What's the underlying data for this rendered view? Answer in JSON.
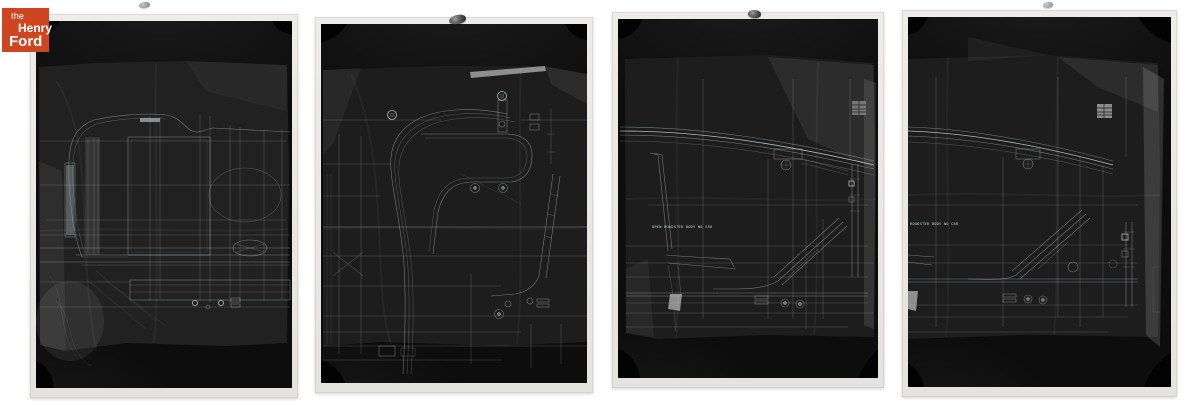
{
  "page": {
    "background_color": "#ffffff",
    "content": "Four black-and-white archival photographs of automotive body blueprint tracings (film negatives) displayed side by side"
  },
  "logo": {
    "name": "The Henry Ford",
    "line1": "the",
    "line2": "Henry",
    "line3": "Ford",
    "background_color": "#cf4520",
    "text_color": "#ffffff"
  },
  "photos": [
    {
      "id": "negative-1",
      "subject": "Body blueprint — cowl, hinge pillar and door side section",
      "label": ""
    },
    {
      "id": "negative-2",
      "subject": "Body blueprint — windshield pillar sweep and door frame corner detail",
      "label": ""
    },
    {
      "id": "negative-3",
      "subject": "Body blueprint — open roadster side elevation with seat profile",
      "label": "OPEN ROADSTER BODY   NO CAR"
    },
    {
      "id": "negative-4",
      "subject": "Body blueprint — open roadster side elevation, shifted crop",
      "label": "OPEN ROADSTER BODY   NO CAR"
    }
  ],
  "colors": {
    "print_border": "#e9e7e3",
    "negative_black": "#0d0d0d",
    "sheet_gray": "#212121",
    "line_white": "#c9d2d6",
    "logo_red": "#cf4520"
  }
}
